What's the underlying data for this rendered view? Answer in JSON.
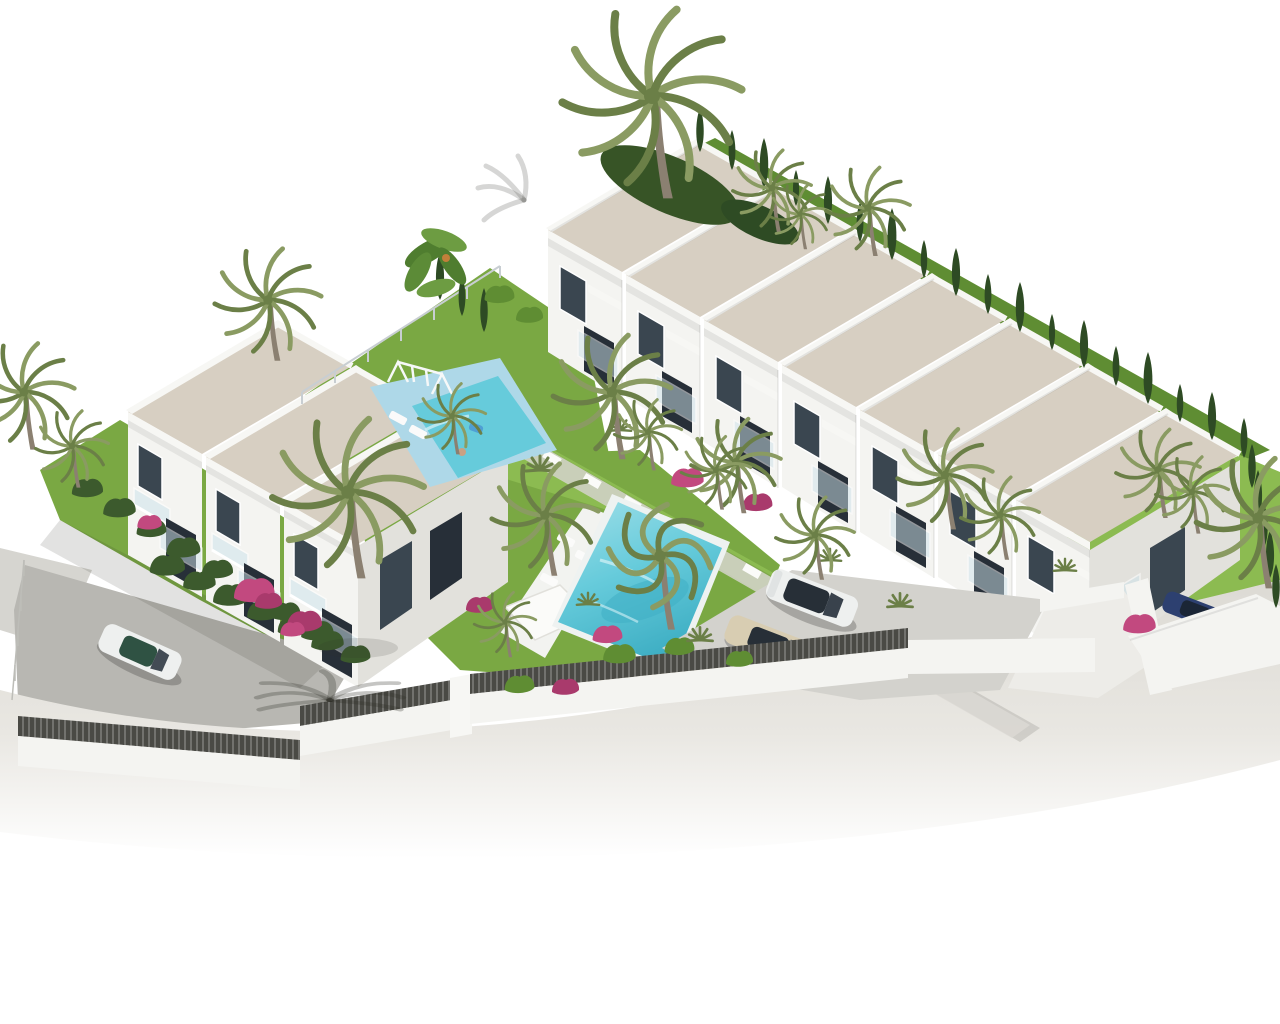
{
  "image": {
    "description": "Aerial isometric 3D architectural rendering of a new-build residential complex: a diagonal row of seven white terraced townhouses with sand-coloured mono-pitch roofs and glass balconies, a separate three-unit two-storey block on the left, communal lawned gardens with palm trees and bougainvillea, a small children's pool with swing set on a light-blue deck, a long turquoise swimming pool with white sun deck, loungers and pergola, a parking area with a white SUV and a beige sedan, a red and a blue car tucked behind a wall on the right, a white hatchback on the grey side road, dark cypress hedging behind the roofs, and a curved white perimeter wall topped with dark slatted fencing beside a pale road that fades to white at the bottom of the frame."
  },
  "inventory": {
    "townhouse_units": 7,
    "left_block_units": 3,
    "pools": 2,
    "cars": [
      {
        "name": "white-hatchback"
      },
      {
        "name": "beige-sedan"
      },
      {
        "name": "white-suv"
      },
      {
        "name": "blue-car"
      },
      {
        "name": "red-car"
      }
    ],
    "amenities": [
      "swing-set",
      "children-pool",
      "main-pool",
      "sun-loungers",
      "pergola",
      "parking-area",
      "perimeter-fence",
      "palm-garden"
    ]
  },
  "colors": {
    "page_bg": "#ffffff",
    "roof": "#d7cfc2",
    "roof_edge": "#c7bfb1",
    "parapet": "#f7f7f4",
    "wall": "#f4f4f1",
    "wall_shade": "#e2e1dc",
    "wall_dark": "#d6d5d0",
    "window": "#3a4650",
    "window_dark": "#272f38",
    "glass_rail": "#cfe4ec",
    "lawn": "#7aa843",
    "lawn_light": "#8cbb51",
    "lawn_dark": "#5f8d33",
    "hedge": "#3c5a2d",
    "cypress": "#2e4b24",
    "palm_frond": "#8a9b62",
    "palm_frond_dark": "#6b7f47",
    "palm_trunk": "#8b8071",
    "pool_deck": "#aed8e8",
    "pool_water": "#66cbdb",
    "pool_water_dark": "#3fafc4",
    "deck_white": "#f2f3f0",
    "road": "#dcdad4",
    "road_deep": "#b8b7b2",
    "sidewalk": "#e9e7e2",
    "parking": "#d3d2cd",
    "gravel": "#cfc2ab",
    "fence": "#4a4a45",
    "car_white": "#eef0ef",
    "car_beige": "#d8cdb2",
    "car_red": "#8f2a3d",
    "car_blue": "#2d4070",
    "car_glass": "#272f37",
    "flower": "#c2497f",
    "flower_deep": "#a93a6c",
    "skin": "#caa183",
    "shadow": "rgba(50,50,45,0.14)",
    "shadow_strong": "rgba(40,40,35,0.26)"
  }
}
